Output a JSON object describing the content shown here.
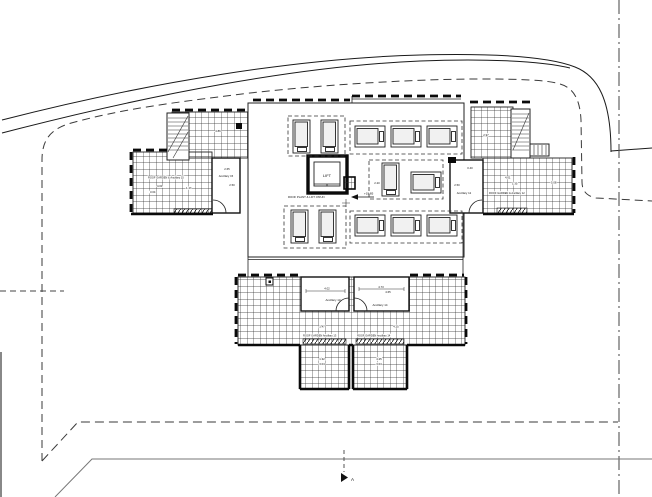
{
  "meta": {
    "drawing_type": "architectural roof plan"
  },
  "colors": {
    "paper": "#ffffff",
    "ink": "#1a1a1a",
    "road_gray": "#777777",
    "boundary_dash": "#3a3a3a",
    "plot_dashdot": "#555555"
  },
  "labels": {
    "lift": "LIFT",
    "lift_note": "ROOF PLANT & LIFT O'RUN",
    "level": "+19.85",
    "section": "A"
  },
  "rooms": {
    "left": {
      "name": "Ancillary 15",
      "dim_a": "2.65",
      "dim_b": "2.50"
    },
    "right": {
      "name": "Ancillary 12",
      "dim_a": "0.40",
      "dim_b": "2.50"
    },
    "bottom_left": {
      "name": "Ancillary 13",
      "dim_a": "4.02"
    },
    "bottom_right": {
      "name": "Ancillary 14",
      "dim_a": "4.73",
      "dim_b": "4.65"
    }
  },
  "gardens": {
    "left": {
      "label": "ROOF GARDEN & Ancillary 15",
      "dim_a": "4.01",
      "dim_b": "3.04",
      "dim_c": "1.47"
    },
    "right": {
      "label": "ROOF GARDEN & Ancillary 12",
      "dim_a": "4.01",
      "dim_b": "1.35",
      "dim_c": "5.08"
    },
    "bottom_left": {
      "label": "ROOF GARDEN Ancillary 13",
      "dim_a": "1.47"
    },
    "bottom_right": {
      "label": "ROOF GARDEN Ancillary 14",
      "dim_a": "4.25"
    },
    "terrace_left": {
      "dim_a": "1.32",
      "dim_b": "3.04"
    },
    "terrace_right": {
      "dim_a": "4.25",
      "dim_b": "3.04"
    }
  },
  "dims": {
    "upper_left": "4.86",
    "upper_right": "2.97",
    "mid": "2.20"
  }
}
